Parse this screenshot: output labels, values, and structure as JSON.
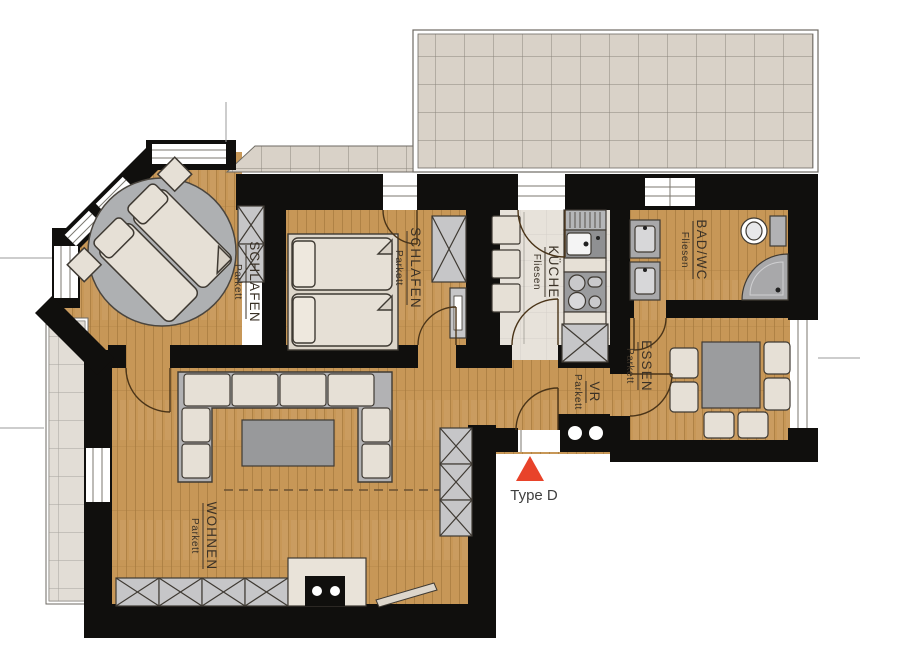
{
  "plan": {
    "type_label": "Type D",
    "marker_color": "#e8432a"
  },
  "rooms": [
    {
      "id": "schlafen-1",
      "name": "SCHLAFEN",
      "flooring": "Parkett"
    },
    {
      "id": "schlafen-2",
      "name": "SCHLAFEN",
      "flooring": "Parkett"
    },
    {
      "id": "kueche",
      "name": "KÜCHE",
      "flooring": "Fliesen"
    },
    {
      "id": "bad-wc",
      "name": "BAD/WC",
      "flooring": "Fliesen"
    },
    {
      "id": "essen",
      "name": "ESSEN",
      "flooring": "Parkett"
    },
    {
      "id": "vr",
      "name": "VR",
      "flooring": "Parkett"
    },
    {
      "id": "wohnen",
      "name": "WOHNEN",
      "flooring": "Parkett"
    }
  ],
  "colors": {
    "wall": "#100f0d",
    "wood_floor": "#c79757",
    "terrace_tile": "#d9d2c8",
    "kitchen_tile": "#e7e2da",
    "furniture_beige": "#e6e0d6",
    "furniture_gray": "#b2b2b4",
    "marker_red": "#e8432a"
  }
}
